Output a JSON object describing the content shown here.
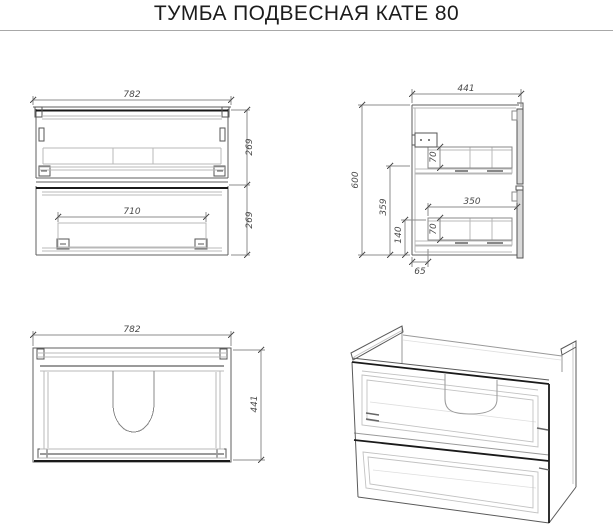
{
  "header": {
    "title": "ТУМБА ПОДВЕСНАЯ КАТЕ 80"
  },
  "views": {
    "front": {
      "label": "front-view",
      "dim_width": "782",
      "dim_inner_width": "710",
      "dim_drawer_top_height": "269",
      "dim_drawer_bottom_height": "269"
    },
    "side": {
      "label": "side-view",
      "dim_depth": "441",
      "dim_height": "600",
      "dim_mid_height": "359",
      "dim_bottom_height": "140",
      "dim_drawer_top_inner": "70",
      "dim_drawer_bottom_inner": "70",
      "dim_drawer_depth": "350",
      "dim_back_offset": "65"
    },
    "top": {
      "label": "top-view",
      "dim_width": "782",
      "dim_depth": "441"
    },
    "iso": {
      "label": "isometric-view"
    }
  },
  "colors": {
    "background": "#ffffff",
    "title_text": "#1c1c1c",
    "separator": "#a8a8a8",
    "line_dark": "#1a1a1a",
    "line_medium": "#5f5f5f",
    "line_light": "#b8b8b8",
    "dimension": "#8c8c8c",
    "dim_text": "#4a4a4a"
  }
}
